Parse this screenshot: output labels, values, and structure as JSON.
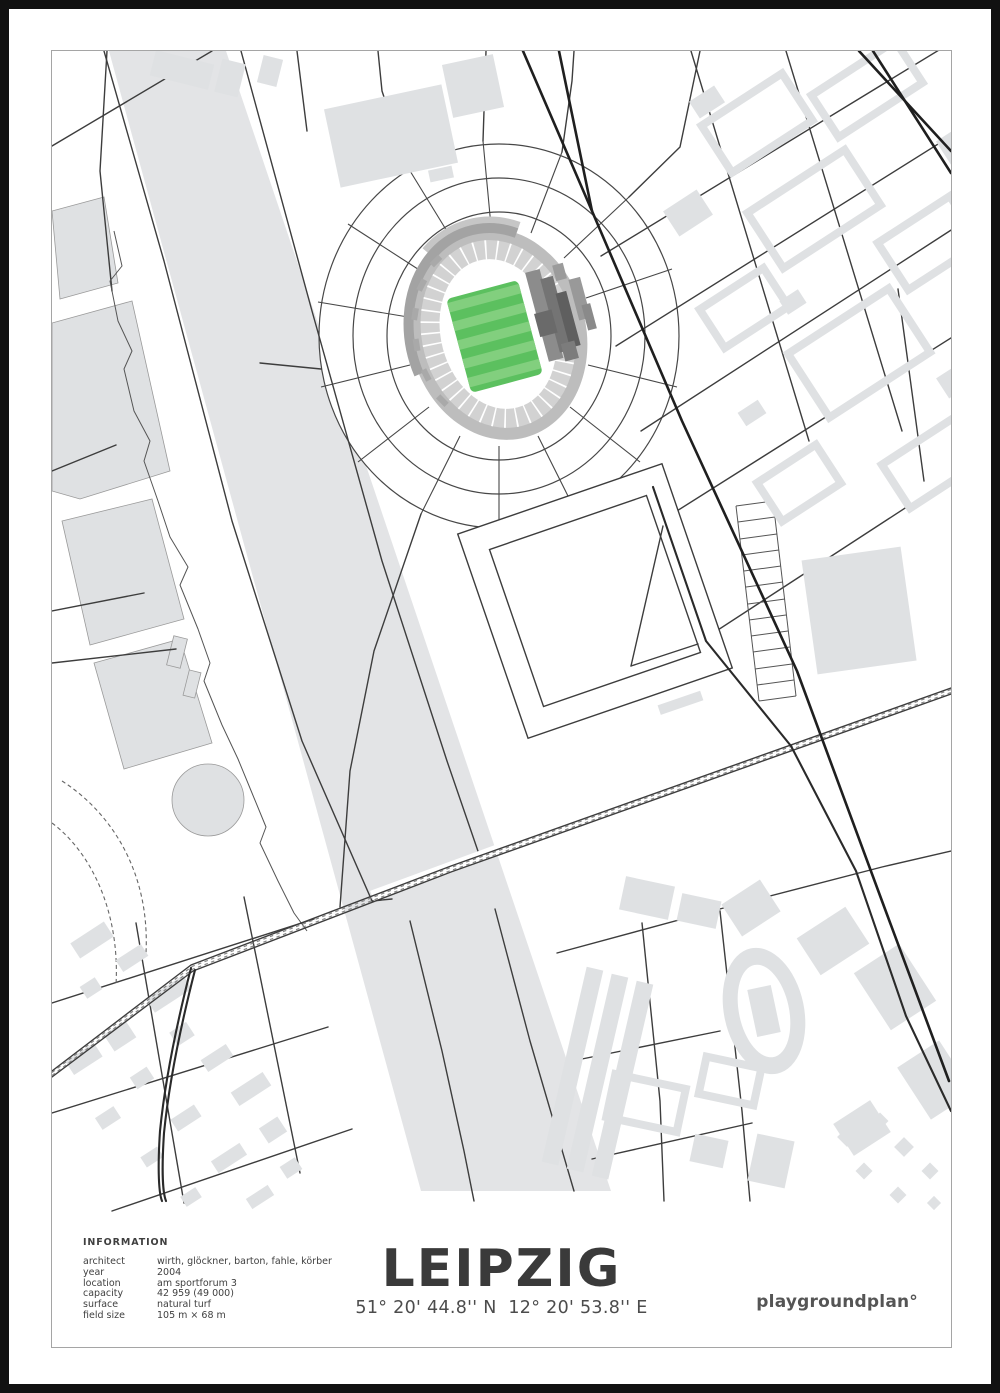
{
  "poster": {
    "title": "LEIPZIG",
    "coordinates": "51° 20' 44.8'' N  12° 20' 53.8'' E",
    "brand": "playgroundplan°",
    "info": {
      "heading": "INFORMATION",
      "rows": [
        {
          "label": "architect",
          "value": "wirth, glöckner, barton, fahle, körber"
        },
        {
          "label": "year",
          "value": "2004"
        },
        {
          "label": "location",
          "value": "am sportforum 3"
        },
        {
          "label": "capacity",
          "value": "42 959 (49 000)"
        },
        {
          "label": "surface",
          "value": "natural turf"
        },
        {
          "label": "field size",
          "value": "105 m × 68 m"
        }
      ]
    }
  },
  "map": {
    "subject": "street map around the Leipzig stadium (am sportforum), pitch highlighted in green",
    "colors": {
      "water_gray": "#e3e4e6",
      "building_gray": "#dfe1e3",
      "pitch_green": "#5cc05f",
      "pitch_stripe": "#82cf7e",
      "rim_gray": "#bdbdbd",
      "seating_gray": "#d2d2d2",
      "stand_dark": "#6e6e6e",
      "road_dark": "#3d3d3d",
      "frame_black": "#111111"
    }
  }
}
